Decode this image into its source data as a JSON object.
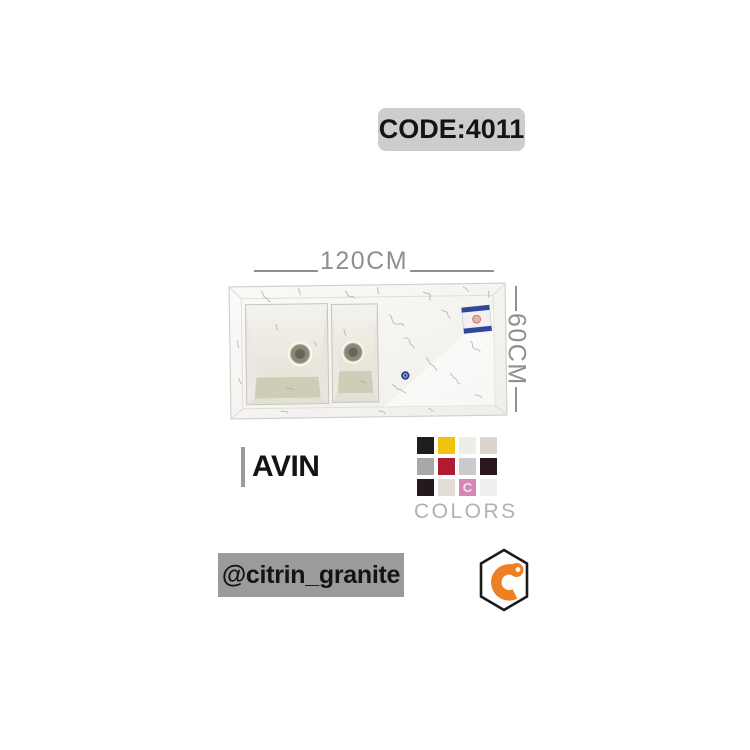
{
  "header": {
    "code_label": "CODE:4011"
  },
  "dimensions": {
    "width": "120CM",
    "height": "60CM"
  },
  "product": {
    "name": "AVIN",
    "description": "double-bowl granite sink with drainboard, white marble finish"
  },
  "colors_section": {
    "title": "COLORS",
    "watermark_glyph": "C",
    "swatches": [
      {
        "name": "black",
        "hex": "#211d1e"
      },
      {
        "name": "yellow",
        "hex": "#f2c30e"
      },
      {
        "name": "white-marble",
        "hex": "#efede8"
      },
      {
        "name": "beige",
        "hex": "#dbd5cd"
      },
      {
        "name": "gray",
        "hex": "#a8a8a8"
      },
      {
        "name": "crimson",
        "hex": "#b11b31"
      },
      {
        "name": "light-gray",
        "hex": "#cbcbce"
      },
      {
        "name": "dark-brown",
        "hex": "#2b181c"
      },
      {
        "name": "black-marble",
        "hex": "#241a1c"
      },
      {
        "name": "cream",
        "hex": "#e3dcd6"
      },
      {
        "name": "pink",
        "hex": "#d585b8",
        "watermark": true
      },
      {
        "name": "white",
        "hex": "#f0eeec"
      }
    ]
  },
  "footer": {
    "handle": "@citrin_granite"
  },
  "theme": {
    "badge_bg": "#cdcdcd",
    "handle_bg": "#9b9b9b",
    "dimension_color": "#8f8f8f",
    "colors_title_color": "#b3b0b0",
    "logo_orange": "#ee7f22",
    "text_black": "#141414"
  }
}
